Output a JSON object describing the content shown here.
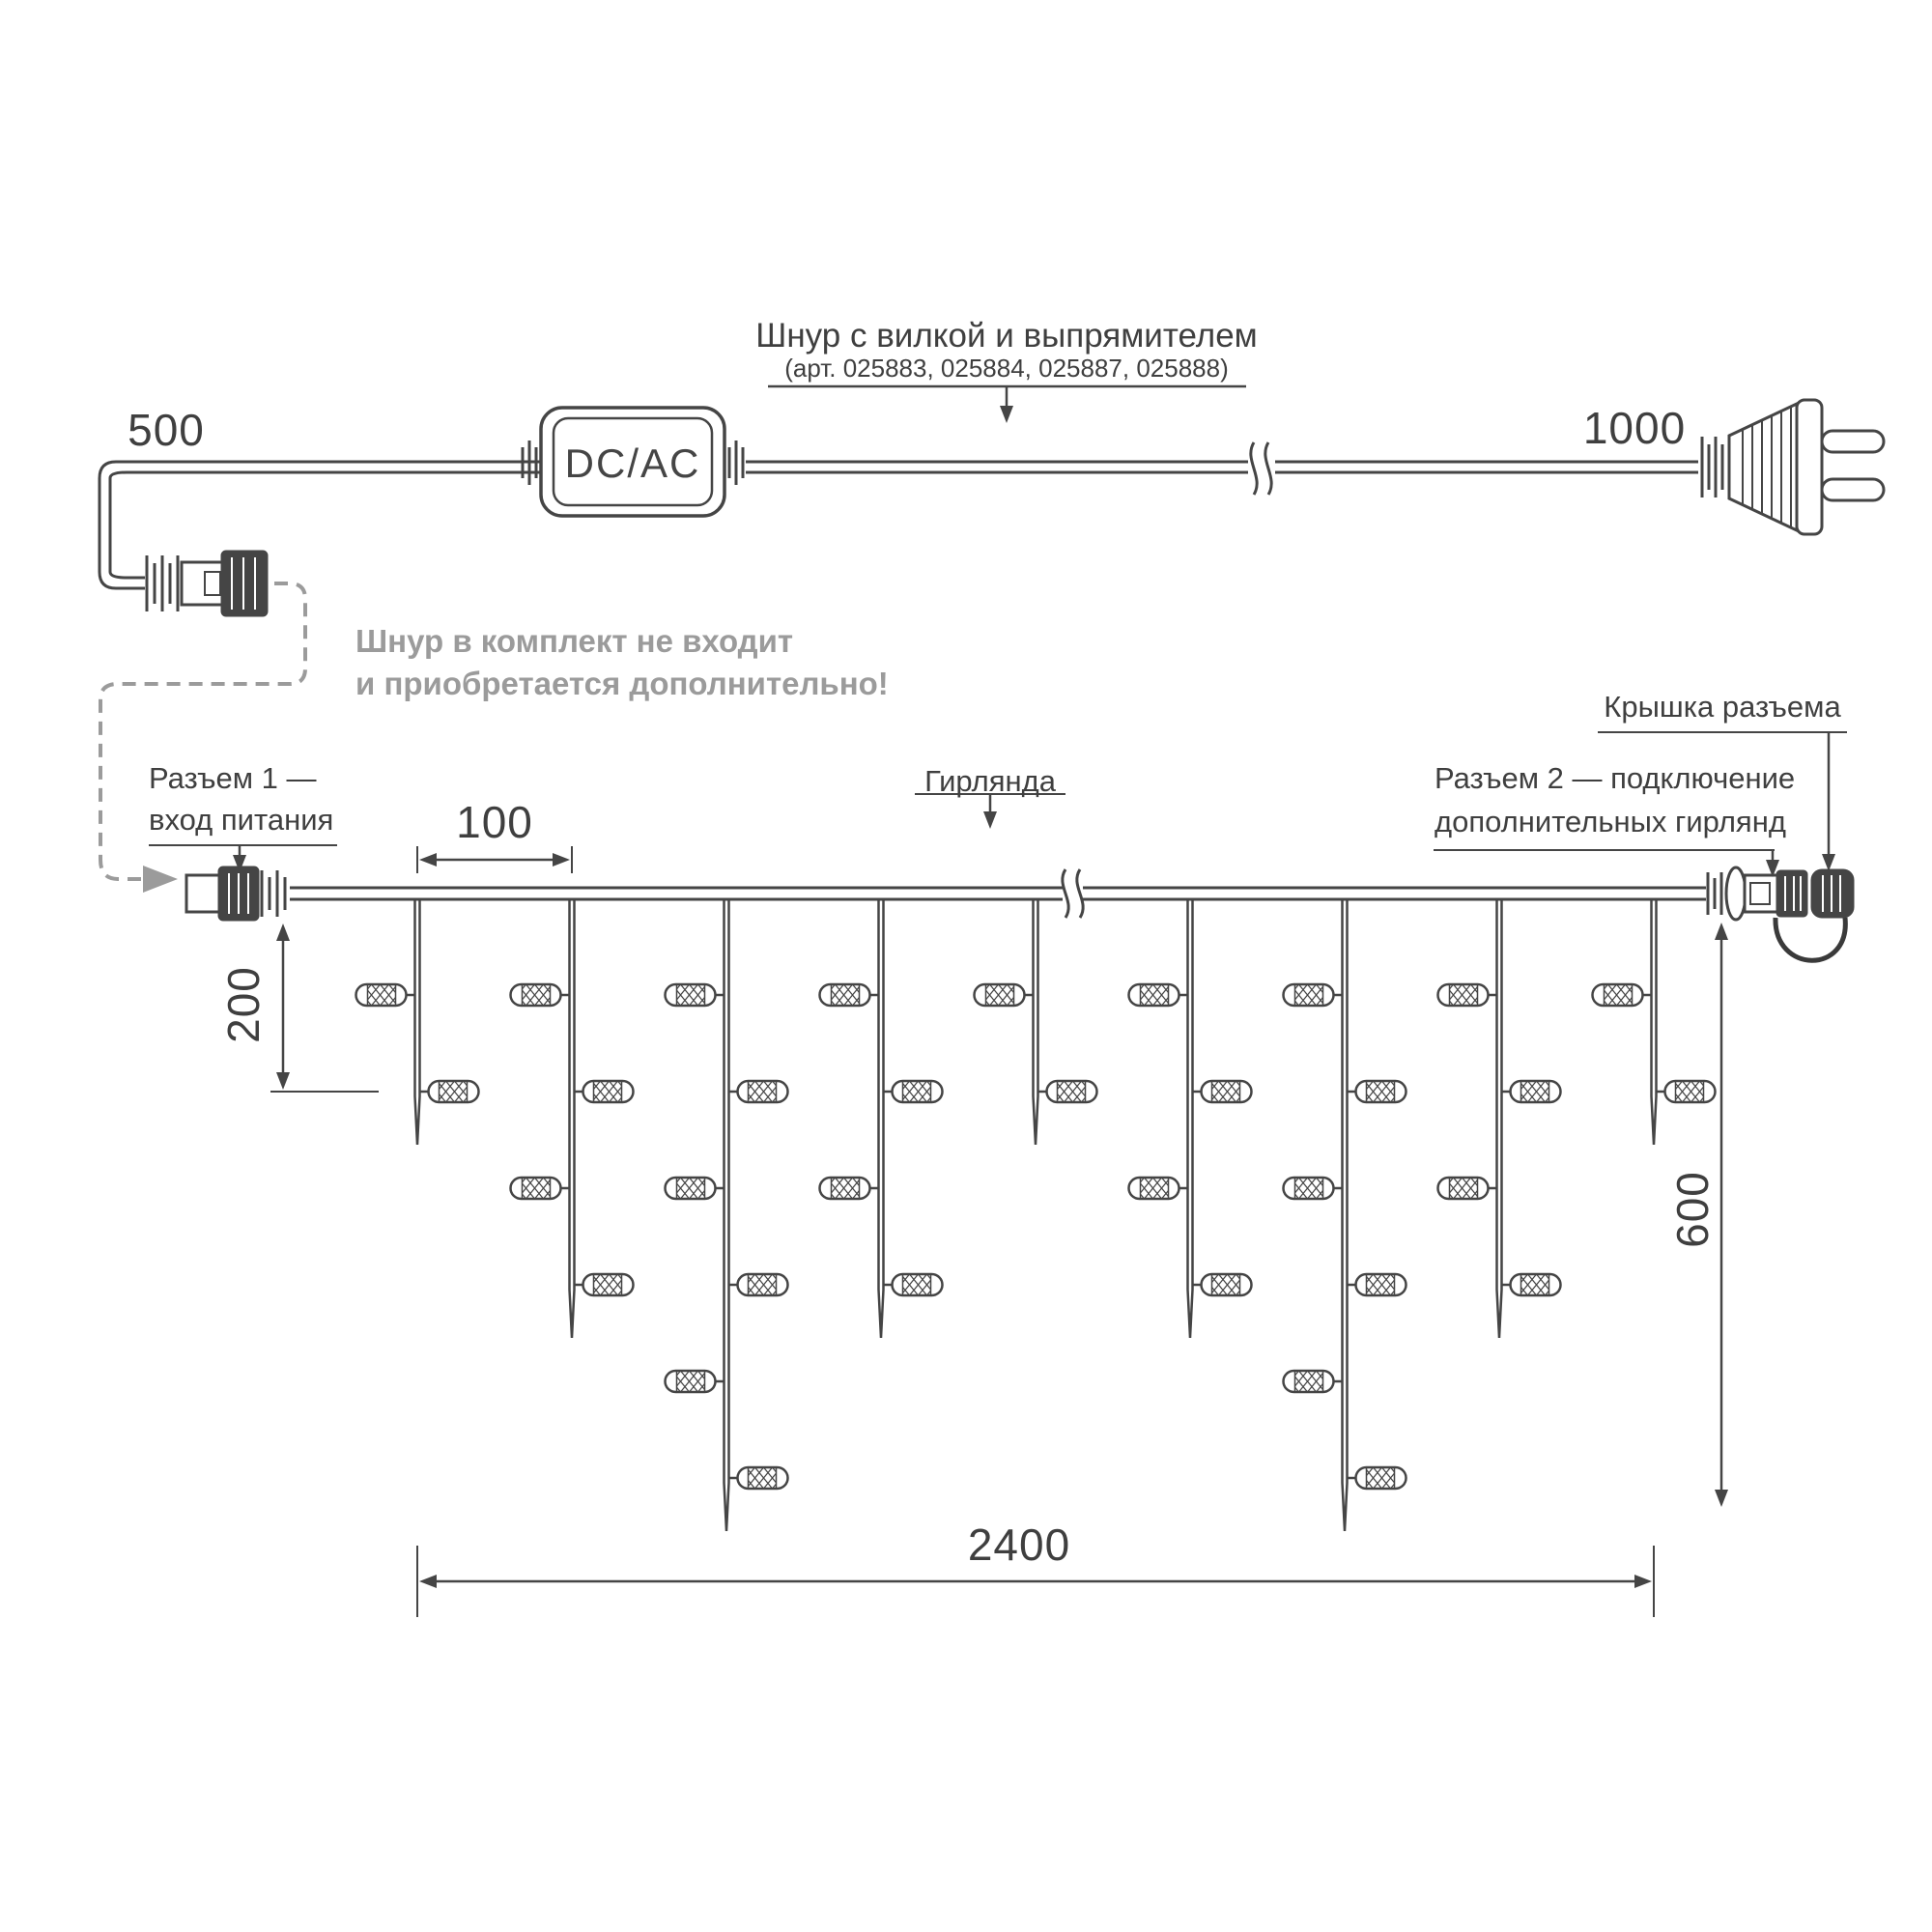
{
  "cord_assembly": {
    "title": "Шнур с вилкой и выпрямителем",
    "subtitle": "(арт. 025883, 025884, 025887, 025888)",
    "dim_left_segment": "500",
    "dim_right_segment": "1000",
    "converter_label": "DC/AC",
    "note_line1": "Шнур в комплект не входит",
    "note_line2": "и приобретается дополнительно!"
  },
  "garland": {
    "connector1_label_line1": "Разъем 1 —",
    "connector1_label_line2": "вход питания",
    "garland_label": "Гирлянда",
    "connector2_label_line1": "Разъем 2 — подключение",
    "connector2_label_line2": "дополнительных гирлянд",
    "cap_label": "Крышка разъема",
    "dim_bulb_spacing": "100",
    "dim_first_drop": "200",
    "dim_height": "600",
    "dim_length": "2400"
  },
  "colors": {
    "line": "#454545",
    "muted": "#9b9b9b",
    "background": "#ffffff"
  }
}
